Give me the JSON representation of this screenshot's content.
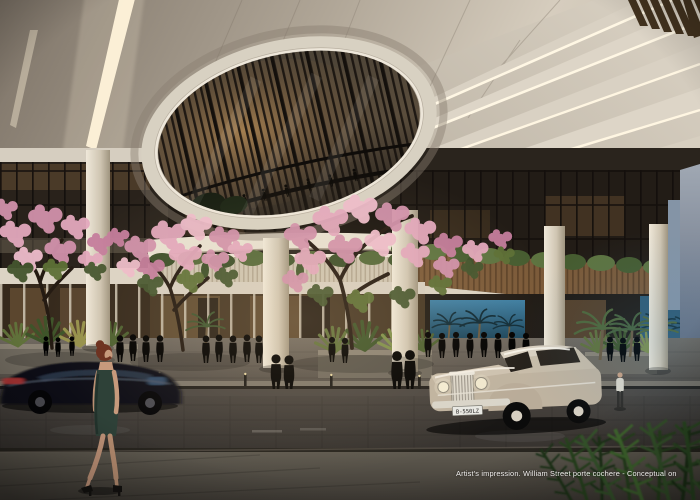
{
  "image": {
    "type": "architectural rendering (artist's impression), dusk scene",
    "caption": "Artist's impression. William Street porte cochere - Conceptual on",
    "classic_car_plate": "B-550LZ"
  },
  "palette": {
    "ceiling": "#cfc6b8",
    "ceiling_shadow": "#877d71",
    "led_strip": "#fff6e0",
    "oculus_rim": "#d8d1c2",
    "oculus_glass": "#3e372e",
    "timber_band": "#7b5a39",
    "foliage": "#4f6434",
    "blossom_pink": "#e3a8bd",
    "column": "#e8e1d2",
    "storefront_glow": "#8a6f49",
    "aquarium_blue": "#2e6a8c",
    "road": "#45403c",
    "classic_car": "#c3b7a3",
    "sedan": "#0e0e12",
    "dress_green": "#2e4138",
    "caption_color": "#eeeceb"
  },
  "scene": {
    "elements": [
      "oval ceiling oculus revealing glazed tower facade with silhouettes",
      "radial lit canopy beams with LED coves",
      "dark timber batten fins at canopy edge",
      "pink trumpet trees along the footpath",
      "mezzanine timber planter band with trailing plants",
      "retail storefronts with warm interior light",
      "blue aquarium-lit wall with palm silhouettes",
      "white porte-cochere columns",
      "pedestrians on walkway and crossing",
      "black sedan in motion blur",
      "champagne classic car arriving",
      "woman in green dress walking in foreground",
      "dark ferns in bottom-right foreground"
    ]
  }
}
